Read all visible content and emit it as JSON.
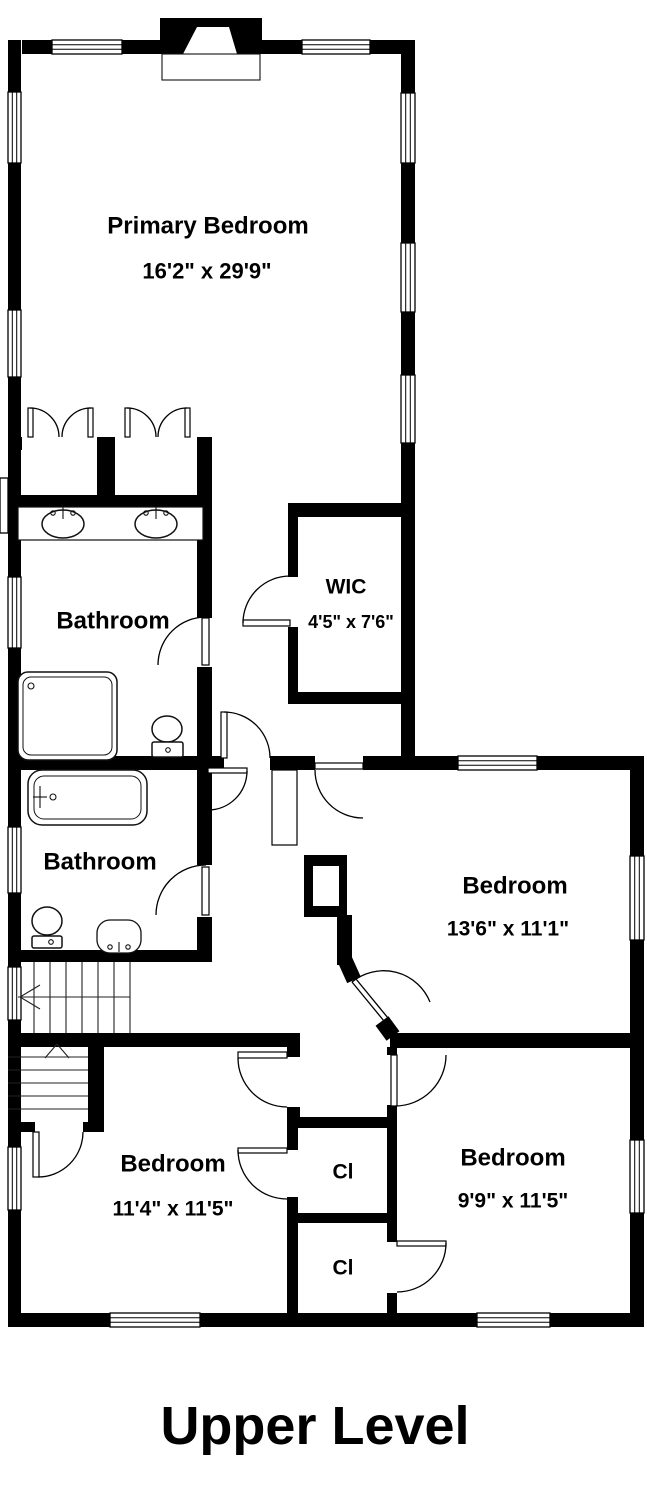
{
  "plan": {
    "title": "Upper Level",
    "level_note": "floor plan, black walls on white background"
  },
  "colors": {
    "walls": "#000000",
    "background": "#ffffff",
    "text": "#000000"
  },
  "rooms": {
    "primary_bedroom": {
      "name": "Primary Bedroom",
      "dims": "16'2\" x 29'9\""
    },
    "primary_bathroom": {
      "name": "Bathroom"
    },
    "wic": {
      "name": "WIC",
      "dims": "4'5\" x 7'6\""
    },
    "hall_bathroom": {
      "name": "Bathroom"
    },
    "bedroom_east": {
      "name": "Bedroom",
      "dims": "13'6\" x 11'1\""
    },
    "bedroom_southwest": {
      "name": "Bedroom",
      "dims": "11'4\" x 11'5\""
    },
    "bedroom_southeast": {
      "name": "Bedroom",
      "dims": "9'9\" x 11'5\""
    },
    "closet_north": {
      "label": "Cl"
    },
    "closet_south": {
      "label": "Cl"
    }
  }
}
